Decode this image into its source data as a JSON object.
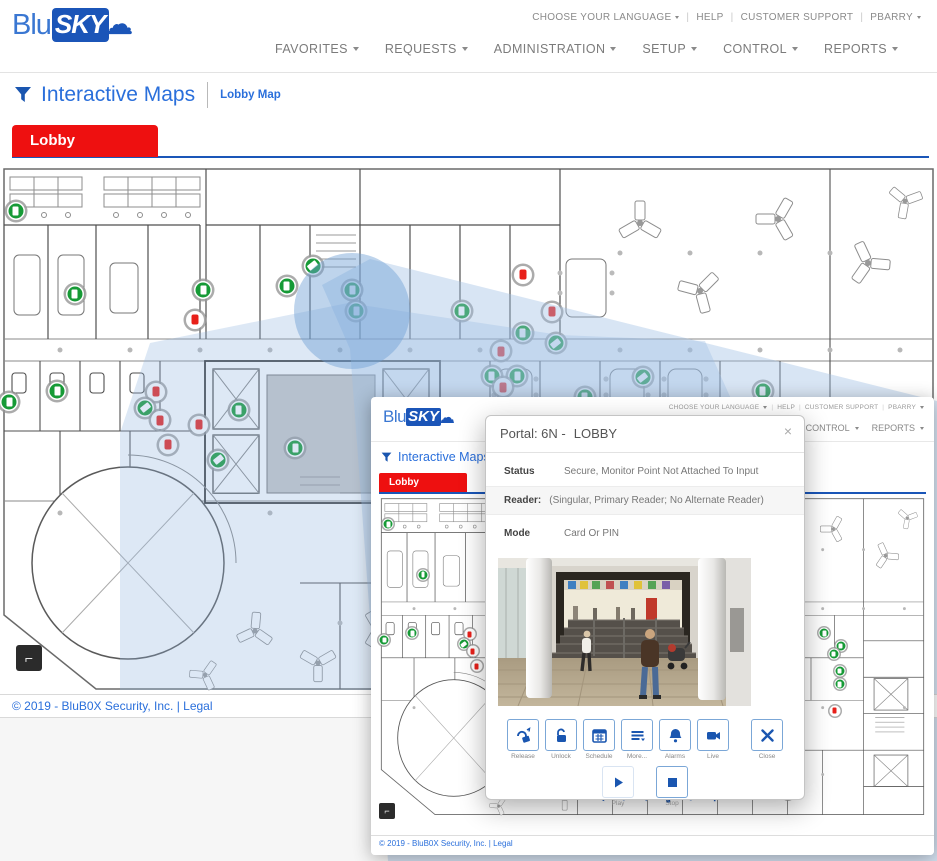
{
  "colors": {
    "accent": "#1a56b0",
    "tab_red": "#ee1010",
    "secure_green": "#169a36",
    "alarm_red": "#e8201a"
  },
  "header": {
    "logo": {
      "blu": "Blu",
      "sky": "SKY",
      "cloud_icon": "cloud"
    },
    "utility": [
      {
        "label": "CHOOSE YOUR LANGUAGE",
        "caret": true
      },
      {
        "label": "HELP",
        "caret": false
      },
      {
        "label": "CUSTOMER SUPPORT",
        "caret": false
      },
      {
        "label": "PBARRY",
        "caret": true
      }
    ],
    "nav": [
      {
        "label": "FAVORITES"
      },
      {
        "label": "REQUESTS"
      },
      {
        "label": "ADMINISTRATION"
      },
      {
        "label": "SETUP"
      },
      {
        "label": "CONTROL"
      },
      {
        "label": "REPORTS"
      }
    ]
  },
  "page": {
    "title": "Interactive Maps",
    "breadcrumb": "Lobby Map",
    "tab": "Lobby",
    "corner_tool_glyph": "⌐"
  },
  "footer": {
    "copyright": "© 2019 - BluB0X Security, Inc. |",
    "legal": "Legal"
  },
  "map": {
    "markers": [
      {
        "x": 1.7,
        "y": 9.1,
        "kind": "door",
        "state": "secure"
      },
      {
        "x": 1.0,
        "y": 45.1,
        "kind": "door",
        "state": "secure"
      },
      {
        "x": 33.4,
        "y": 19.4,
        "kind": "camera",
        "state": "secure"
      },
      {
        "x": 37.6,
        "y": 24.0,
        "kind": "door",
        "state": "secure"
      },
      {
        "x": 38.0,
        "y": 27.9,
        "kind": "door",
        "state": "secure"
      },
      {
        "x": 49.3,
        "y": 27.9,
        "kind": "door",
        "state": "secure"
      },
      {
        "x": 8.0,
        "y": 24.7,
        "kind": "door",
        "state": "secure"
      },
      {
        "x": 21.7,
        "y": 24.0,
        "kind": "door",
        "state": "secure"
      },
      {
        "x": 30.6,
        "y": 23.2,
        "kind": "door",
        "state": "secure"
      },
      {
        "x": 20.8,
        "y": 29.6,
        "kind": "door",
        "state": "alarm"
      },
      {
        "x": 55.8,
        "y": 21.1,
        "kind": "door",
        "state": "alarm"
      },
      {
        "x": 58.9,
        "y": 28.1,
        "kind": "door",
        "state": "alarm"
      },
      {
        "x": 55.8,
        "y": 32.1,
        "kind": "door",
        "state": "secure"
      },
      {
        "x": 53.5,
        "y": 35.5,
        "kind": "door",
        "state": "alarm"
      },
      {
        "x": 59.3,
        "y": 34.0,
        "kind": "camera",
        "state": "secure"
      },
      {
        "x": 52.5,
        "y": 40.2,
        "kind": "door",
        "state": "secure"
      },
      {
        "x": 55.2,
        "y": 40.2,
        "kind": "door",
        "state": "secure"
      },
      {
        "x": 53.7,
        "y": 42.3,
        "kind": "door",
        "state": "alarm"
      },
      {
        "x": 68.6,
        "y": 40.4,
        "kind": "camera",
        "state": "secure"
      },
      {
        "x": 81.4,
        "y": 43.0,
        "kind": "door",
        "state": "secure"
      },
      {
        "x": 16.6,
        "y": 43.2,
        "kind": "door",
        "state": "alarm"
      },
      {
        "x": 15.5,
        "y": 46.2,
        "kind": "camera",
        "state": "secure"
      },
      {
        "x": 17.1,
        "y": 48.5,
        "kind": "door",
        "state": "alarm"
      },
      {
        "x": 17.9,
        "y": 53.2,
        "kind": "door",
        "state": "alarm"
      },
      {
        "x": 21.2,
        "y": 49.4,
        "kind": "door",
        "state": "alarm"
      },
      {
        "x": 25.5,
        "y": 46.6,
        "kind": "door",
        "state": "secure"
      },
      {
        "x": 23.3,
        "y": 56.0,
        "kind": "camera",
        "state": "secure"
      },
      {
        "x": 31.5,
        "y": 53.8,
        "kind": "door",
        "state": "secure"
      },
      {
        "x": 6.1,
        "y": 43.0,
        "kind": "door",
        "state": "secure"
      },
      {
        "x": 62.4,
        "y": 44.2,
        "kind": "door",
        "state": "secure"
      },
      {
        "x": 84.4,
        "y": 46.9,
        "kind": "door",
        "state": "secure"
      },
      {
        "x": 83.1,
        "y": 49.4,
        "kind": "door",
        "state": "secure"
      },
      {
        "x": 84.2,
        "y": 54.7,
        "kind": "door",
        "state": "secure"
      },
      {
        "x": 84.2,
        "y": 58.8,
        "kind": "door",
        "state": "secure"
      },
      {
        "x": 83.3,
        "y": 67.0,
        "kind": "door",
        "state": "alarm"
      },
      {
        "x": 74.7,
        "y": 92.8,
        "kind": "door",
        "state": "secure"
      }
    ]
  },
  "modal": {
    "title_prefix": "Portal: 6N -",
    "title_name": "LOBBY",
    "close_glyph": "×",
    "status": {
      "label": "Status",
      "value": "Secure, Monitor Point Not Attached To Input"
    },
    "reader": {
      "label": "Reader:",
      "value": "(Singular, Primary Reader; No Alternate Reader)"
    },
    "mode": {
      "label": "Mode",
      "value": "Card Or PIN"
    },
    "actions": [
      {
        "label": "Release"
      },
      {
        "label": "Unlock"
      },
      {
        "label": "Schedule"
      },
      {
        "label": "More..."
      },
      {
        "label": "Alarms"
      },
      {
        "label": "Live"
      },
      {
        "label": "Close"
      }
    ],
    "playback": [
      {
        "label": "Play"
      },
      {
        "label": "Stop"
      }
    ]
  },
  "inset": {
    "partial_icons_glyphs": "◂ ● ▾ ▮ ● ✛"
  }
}
